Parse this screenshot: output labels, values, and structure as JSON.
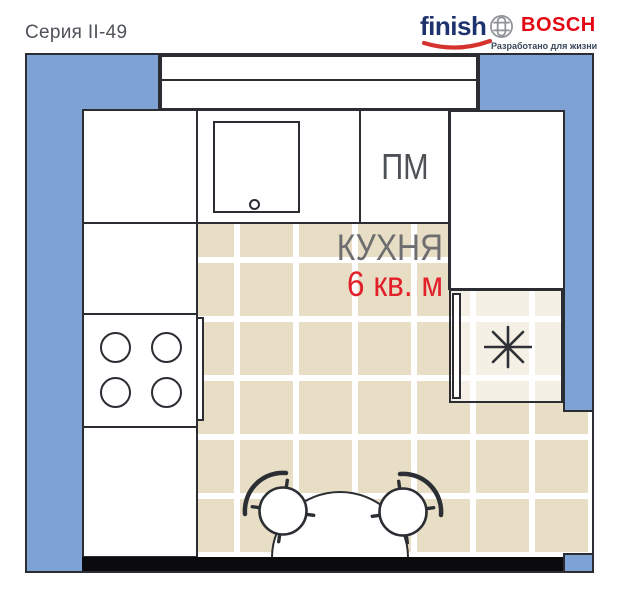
{
  "header": {
    "series": "Серия II-49"
  },
  "branding": {
    "finish": "finish",
    "bosch": "BOSCH",
    "tagline": "Разработано для жизни"
  },
  "room": {
    "name": "КУХНЯ",
    "area": "6 кв. м",
    "dishwasher": "ПМ"
  },
  "icons": {
    "fridge": "snowflake-icon",
    "stove": "four-burners",
    "sink": "basin-with-drain"
  },
  "colors": {
    "wall_blue": "#7da2d3",
    "floor_tile": "#e8dec5",
    "grout_white": "#ffffff",
    "outline_dark": "#2b2d33",
    "bottom_wall_black": "#0b0b0d",
    "area_text_red": "#e1202a",
    "room_text_gray": "#6e6e70",
    "bosch_red": "#e30613",
    "finish_navy": "#1e336e"
  }
}
